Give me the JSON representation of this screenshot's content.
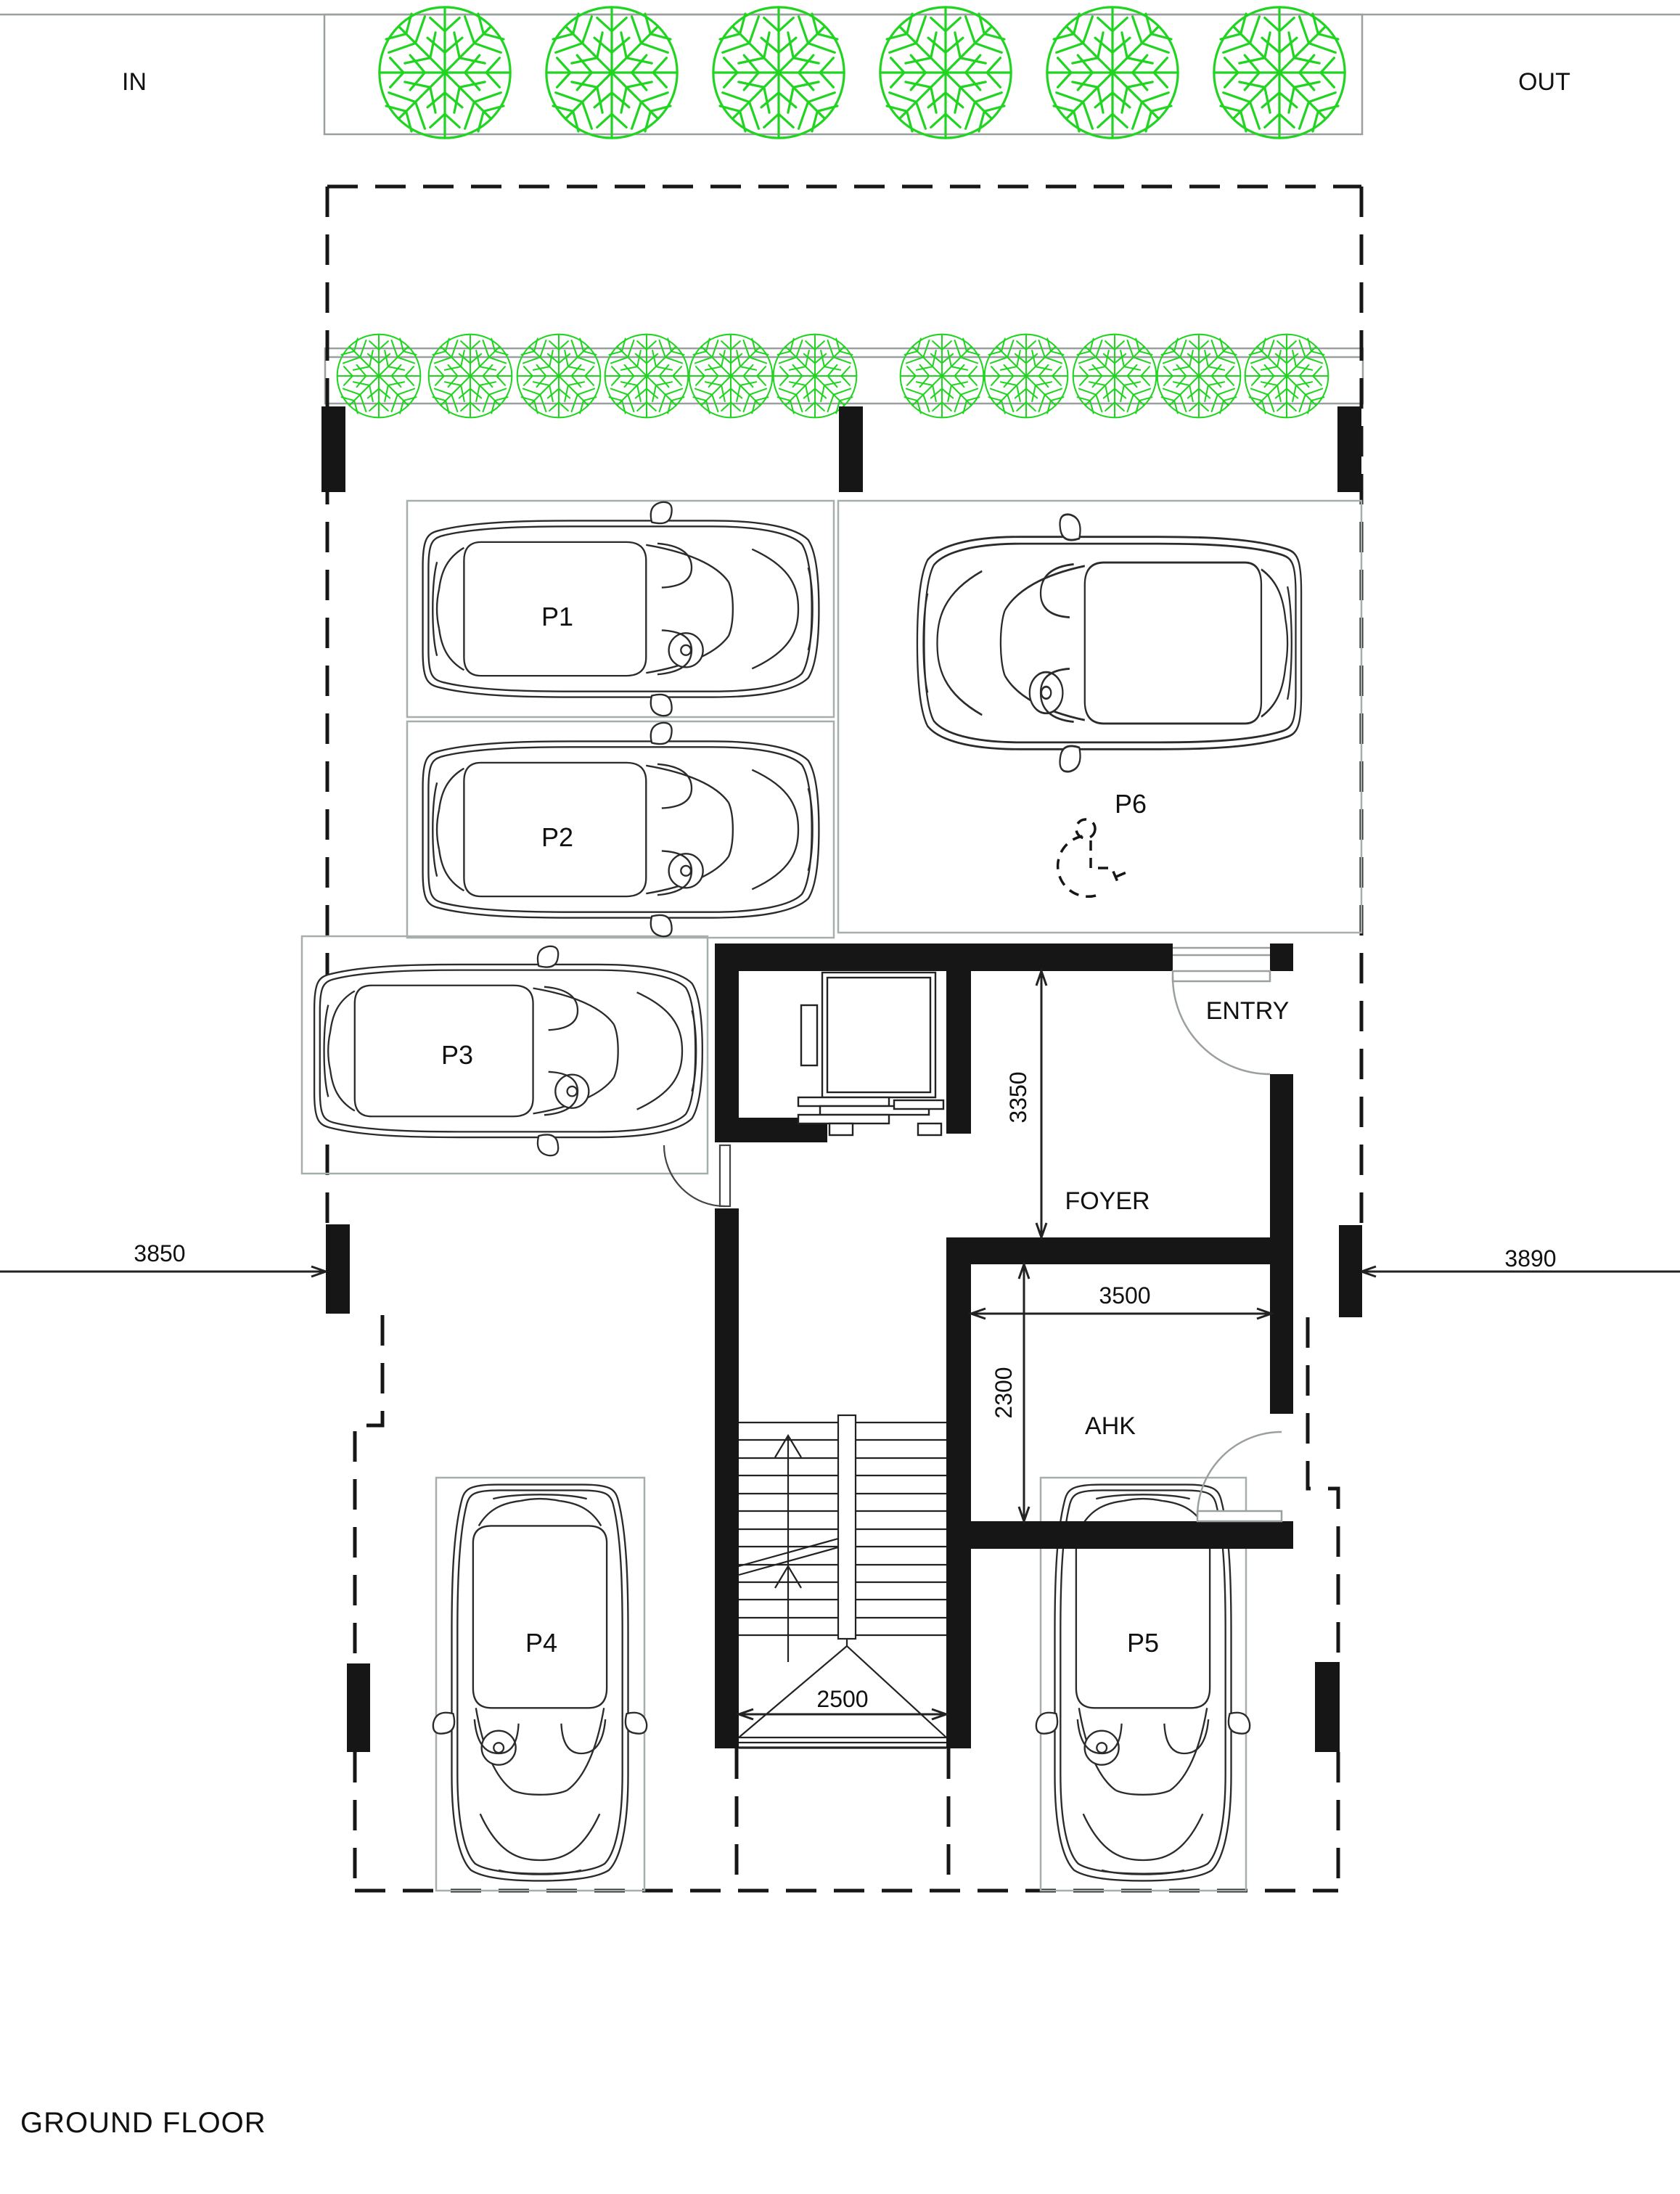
{
  "page": {
    "title_label": "GROUND FLOOR"
  },
  "site": {
    "in_label": "IN",
    "out_label": "OUT"
  },
  "parking_spots": {
    "p1": "P1",
    "p2": "P2",
    "p3": "P3",
    "p4": "P4",
    "p5": "P5",
    "p6": "P6"
  },
  "rooms": {
    "entry": "ENTRY",
    "foyer": "FOYER",
    "ahk": "AHK"
  },
  "dimensions": {
    "foyer_depth": "3350",
    "ahk_width": "3500",
    "ahk_depth": "2300",
    "stair_width": "2500",
    "left_setback": "3850",
    "right_setback": "3890"
  },
  "icons": {
    "tree": "tree-icon",
    "accessible_parking": "wheelchair-icon",
    "stairs": "stairs-icon",
    "elevator": "elevator-icon",
    "door_swing": "door-swing-icon"
  },
  "colors": {
    "tree_green": "#21d421",
    "drawing_black": "#161616",
    "parking_box_gray": "#a7aeae",
    "site_line_gray": "#9aa0a0",
    "car_line": "#2b2b2b"
  }
}
